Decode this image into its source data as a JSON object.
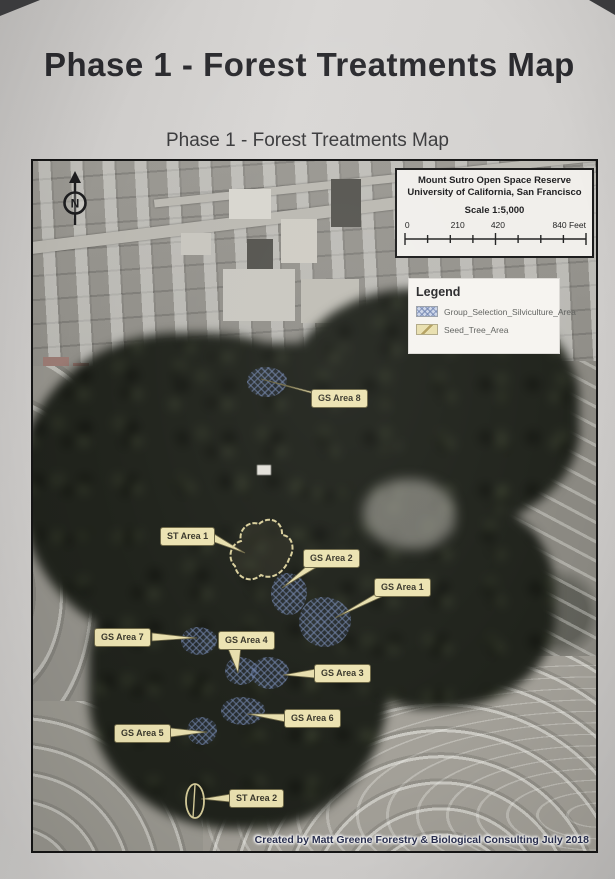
{
  "page": {
    "title": "Phase 1 - Forest Treatments Map",
    "map_title": "Phase 1 - Forest Treatments Map"
  },
  "map": {
    "north_label": "N",
    "info_box": {
      "line1": "Mount Sutro Open Space Reserve",
      "line2": "University of California, San Francisco",
      "scale_text": "Scale 1:5,000",
      "scale_tick_labels": [
        "0",
        "210",
        "420",
        "840 Feet"
      ]
    },
    "legend": {
      "title": "Legend",
      "items": [
        {
          "label": "Group_Selection_Silviculture_Area",
          "pattern": "blue-crosshatch",
          "swatch_color": "#ccd6e8"
        },
        {
          "label": "Seed_Tree_Area",
          "pattern": "tan-diagonal",
          "swatch_color": "#e8dfae"
        }
      ]
    },
    "area_labels": [
      {
        "text": "GS Area 8"
      },
      {
        "text": "ST Area 1"
      },
      {
        "text": "GS Area 2"
      },
      {
        "text": "GS Area 1"
      },
      {
        "text": "GS Area 7"
      },
      {
        "text": "GS Area 4"
      },
      {
        "text": "GS Area 3"
      },
      {
        "text": "GS Area 6"
      },
      {
        "text": "GS Area 5"
      },
      {
        "text": "ST Area 2"
      }
    ],
    "credit": "Created by Matt Greene Forestry & Biological Consulting July 2018",
    "colors": {
      "callout_bg": "#ece3b2",
      "group_selection_hatch_blue": "#7a8eb8",
      "seed_tree_outline_tan": "#d9cf9c",
      "paper": "#d2d0ce"
    }
  }
}
